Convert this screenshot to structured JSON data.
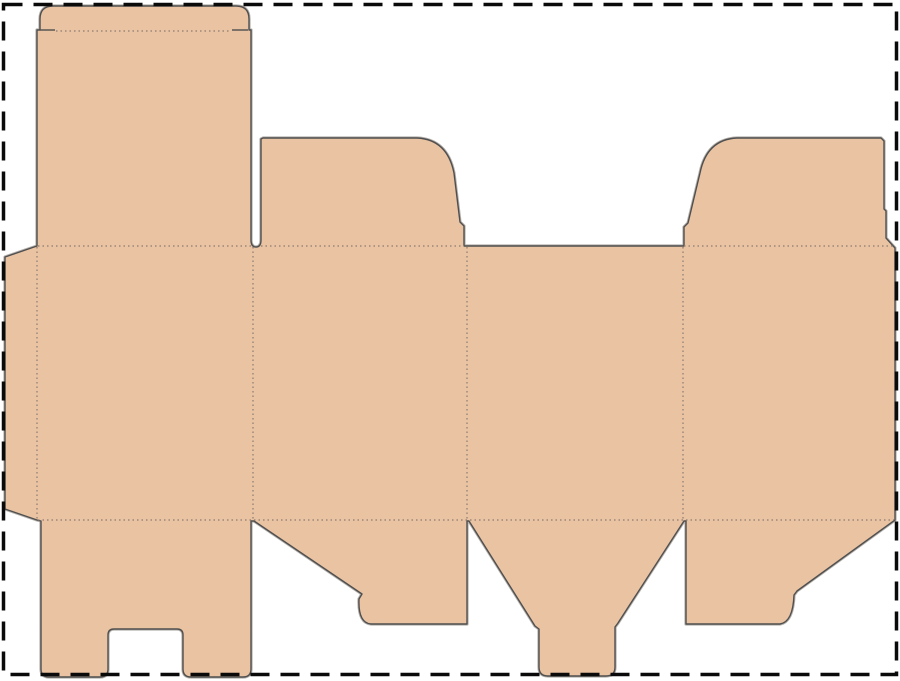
{
  "diagram": {
    "kind": "packaging-dieline",
    "canvas": {
      "width": 900,
      "height": 681,
      "background": "#ffffff"
    },
    "colors": {
      "board_fill": "#e9c3a2",
      "cut_line": "#4f4f4f",
      "cut_line_halo": "#b5b0ab",
      "fold_line": "#8a7b70",
      "page_border": "#0a0a0a"
    },
    "page_border": {
      "x": 3.5,
      "y": 4.5,
      "width": 893,
      "height": 670,
      "stroke_width": 3.5,
      "dash": "19 11"
    },
    "silhouette": {
      "name": "dieline-silhouette",
      "path": "M 53,6 L 236,6 Q 249,6 249,19 L 249,30 L 251,30 L 251,240 Q 251,247 256,247 Q 261,247 261,240 L 261,139 L 263,138 L 417,138 C 439,139 450,153 454,173 L 460,222 L 464,226 L 464,246 L 684,246 L 684,227 L 688,223 L 700,173 C 704,153 715,139 737,138 L 881,138 L 884,141 L 884,209 L 886,211 L 886,238 L 895,248 L 895,520 L 797,591 L 794,595 Q 793,622 780,624 L 686,624 L 686,521 L 684,521 L 618,623 L 615,627 L 615,667 Q 615,676 606,676 L 548,676 Q 539,676 539,667 L 539,629 L 535,626 L 469,521 L 467,521 L 467,624 L 371,624 Q 358,623 359,599 L 362,594 L 254,521 L 251,521 L 251,669 Q 251,677 243,677 L 191,677 Q 183,677 183,669 L 183,635 Q 183,629 177,629 L 114,629 Q 108,629 108,635 L 108,669 Q 108,677 100,677 L 49,677 Q 41,677 41,669 L 41,521 L 37,520 L 5,509 L 5,257 L 37,246 L 37,30 L 40,30 L 40,19 Q 40,6 53,6 Z",
      "stroke_width": 1.4
    },
    "slits": [
      {
        "name": "tuck-flap-slit-left",
        "x1": 40,
        "y1": 30,
        "x2": 55,
        "y2": 30
      },
      {
        "name": "tuck-flap-slit-right",
        "x1": 232,
        "y1": 30,
        "x2": 248,
        "y2": 30
      }
    ],
    "fold_lines": [
      {
        "name": "fold-tuck-lip",
        "x1": 56,
        "y1": 31,
        "x2": 231,
        "y2": 31
      },
      {
        "name": "fold-top-panel-1",
        "x1": 38,
        "y1": 246,
        "x2": 251,
        "y2": 246
      },
      {
        "name": "fold-top-panel-2",
        "x1": 261,
        "y1": 246,
        "x2": 464,
        "y2": 246
      },
      {
        "name": "fold-top-panel-4",
        "x1": 684,
        "y1": 246,
        "x2": 894,
        "y2": 246
      },
      {
        "name": "fold-bottom-panels",
        "x1": 38,
        "y1": 520,
        "x2": 894,
        "y2": 520
      },
      {
        "name": "fold-glue-tab",
        "x1": 37,
        "y1": 247,
        "x2": 37,
        "y2": 519
      },
      {
        "name": "fold-panel-1-2",
        "x1": 253,
        "y1": 247,
        "x2": 253,
        "y2": 519
      },
      {
        "name": "fold-panel-2-3",
        "x1": 467,
        "y1": 247,
        "x2": 467,
        "y2": 519
      },
      {
        "name": "fold-panel-3-4",
        "x1": 683,
        "y1": 247,
        "x2": 683,
        "y2": 519
      }
    ],
    "fold_style": {
      "stroke_width": 1.2,
      "dash": "1.5 3"
    }
  }
}
